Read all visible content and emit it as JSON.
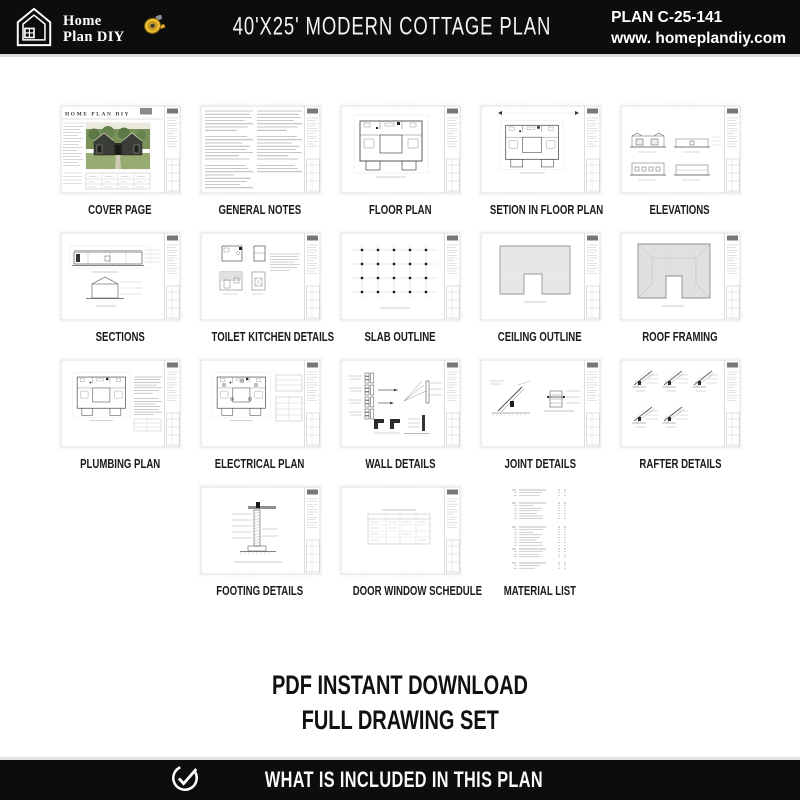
{
  "header": {
    "brand": {
      "line1": "Home",
      "line2": "Plan DIY"
    },
    "title": "40'X25' MODERN COTTAGE PLAN",
    "plan_code": "PLAN C-25-141",
    "website": "www. homeplandiy.com"
  },
  "sheets": {
    "cover_heading": "HOME PLAN DIY",
    "rows": [
      [
        {
          "label": "COVER PAGE",
          "kind": "cover"
        },
        {
          "label": "GENERAL NOTES",
          "kind": "notes"
        },
        {
          "label": "FLOOR PLAN",
          "kind": "floorplan"
        },
        {
          "label": "SETION IN FLOOR PLAN",
          "kind": "floorplan2"
        },
        {
          "label": "ELEVATIONS",
          "kind": "elevations"
        }
      ],
      [
        {
          "label": "SECTIONS",
          "kind": "sections"
        },
        {
          "label": "TOILET KITCHEN DETAILS",
          "kind": "toilet"
        },
        {
          "label": "SLAB OUTLINE",
          "kind": "slab"
        },
        {
          "label": "CEILING OUTLINE",
          "kind": "ceiling"
        },
        {
          "label": "ROOF FRAMING",
          "kind": "roof"
        }
      ],
      [
        {
          "label": "PLUMBING PLAN",
          "kind": "plumbing"
        },
        {
          "label": "ELECTRICAL PLAN",
          "kind": "electrical"
        },
        {
          "label": "WALL DETAILS",
          "kind": "walls"
        },
        {
          "label": "JOINT DETAILS",
          "kind": "joints"
        },
        {
          "label": "RAFTER DETAILS",
          "kind": "rafters"
        }
      ],
      [
        {
          "label": "FOOTING DETAILS",
          "kind": "footing"
        },
        {
          "label": "DOOR WINDOW SCHEDULE",
          "kind": "schedule"
        },
        {
          "label": "MATERIAL LIST",
          "kind": "materials"
        }
      ]
    ]
  },
  "download": {
    "line1": "PDF INSTANT DOWNLOAD",
    "line2": "FULL DRAWING SET"
  },
  "footer_bar": {
    "label": "WHAT IS INCLUDED IN THIS PLAN"
  },
  "icons": {
    "brand": "house-outline-icon",
    "title": "tape-measure-icon",
    "footer": "check-circle-icon"
  },
  "colors": {
    "header_bg": "#0d0d0d",
    "footer_bg": "#0d0d0d",
    "tape_yellow": "#e5b52e",
    "page_border": "#c6c6c6",
    "label_text": "#1b1b1b",
    "cover_trees": "#6b8452",
    "cover_lawn": "#97ab72",
    "cover_house": "#3a3e36"
  }
}
